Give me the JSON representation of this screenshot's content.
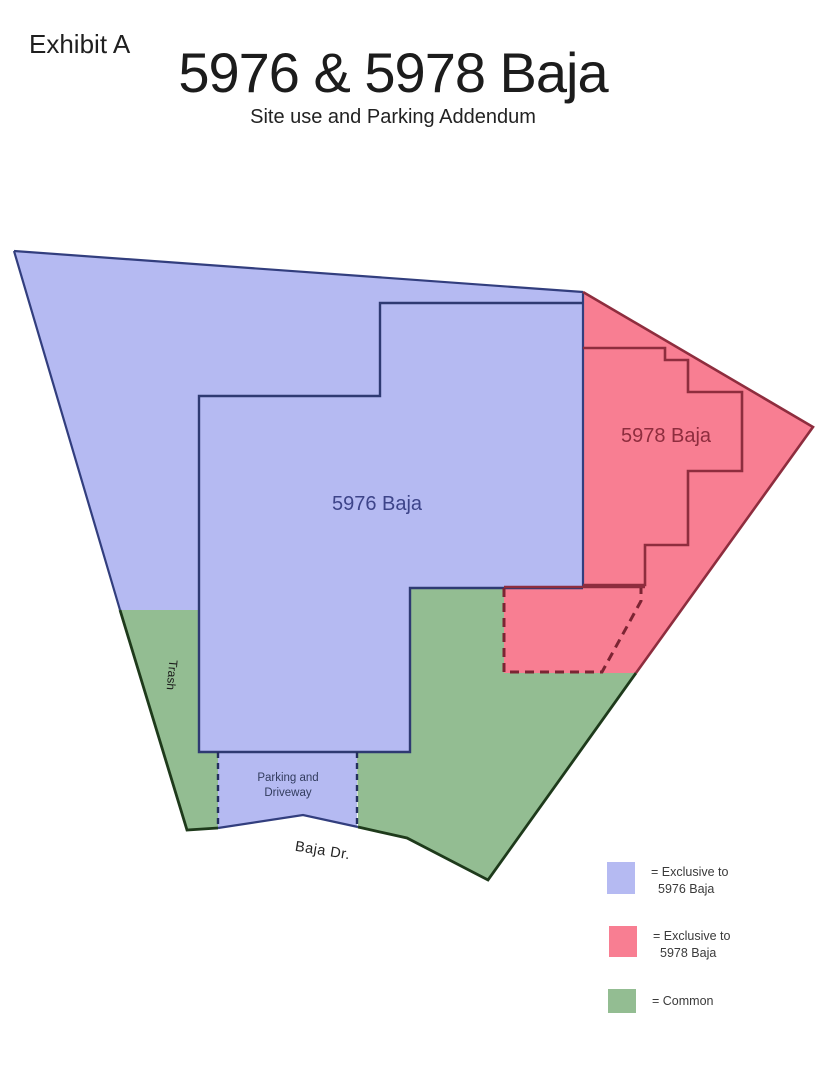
{
  "header": {
    "exhibit_label": "Exhibit A",
    "title": "5976 & 5978 Baja",
    "subtitle": "Site use and Parking Addendum"
  },
  "colors": {
    "blue_fill": "#b5baf2",
    "blue_line": "#323e7e",
    "red_fill": "#f87e92",
    "red_line": "#8e2d3e",
    "green_fill": "#93bd92",
    "green_line": "#1e3a1b",
    "label_5976_text": "#3d4489",
    "label_5978_text": "#8e2d3e",
    "header_text": "#1f1f1f",
    "legend_text": "#3a3a3a"
  },
  "map": {
    "regions": {
      "blue": {
        "name": "Exclusive to 5976 Baja",
        "points": "14,251 583,292 583,588 410,588 410,752 357,752 357,827 303,815 218,828 218,752 199,752 199,610 120,610"
      },
      "red": {
        "name": "Exclusive to 5978 Baja",
        "points": "583,292 813,427 636,673 504,673 504,588 583,588"
      },
      "green_left": {
        "name": "Common - trash strip",
        "points": "120,610 199,610 199,752 218,752 218,828 187,830"
      },
      "green_right": {
        "name": "Common - yard",
        "points": "410,588 504,588 504,673 636,673 488,880 407,838 358,827 357,752 410,752"
      }
    },
    "outlines": {
      "outer_blue": "M14,251 L583,292 M14,251 L120,610 M583,292 L583,587",
      "building_5976": "M583,303 L380,303 L380,396 L199,396 L199,752 L410,752 L410,588 L583,588",
      "parking_road_edge": "M218,828 L303,815 L358,827",
      "parking_dashed_left": "M218,752 L218,828",
      "parking_dashed_right": "M357,752 L357,827",
      "outer_red": "M583,292 L813,427 L636,673",
      "building_5978": "M583,348 L665,348 L665,360 L688,360 L688,392 L742,392 L742,471 L688,471 L688,545 L645,545 L645,585 L583,585",
      "red_parking_top": "M504,587 L645,587",
      "red_parking_dashed": "M504,588 L504,672 L602,672 L641,601 L641,588",
      "outer_green": "M120,610 L187,830 L218,828 M358,827 L407,838 L488,880 L636,673"
    },
    "labels": {
      "building_5976": "5976 Baja",
      "building_5978": "5978 Baja",
      "trash": "Trash",
      "parking_line1": "Parking and",
      "parking_line2": "Driveway",
      "street": "Baja Dr."
    }
  },
  "legend": {
    "items": [
      {
        "line1": "= Exclusive to",
        "line2": "5976 Baja",
        "color": "#b5baf2"
      },
      {
        "line1": "= Exclusive to",
        "line2": "5978 Baja",
        "color": "#f87e92"
      },
      {
        "line1": "= Common",
        "line2": "",
        "color": "#93bd92"
      }
    ]
  }
}
